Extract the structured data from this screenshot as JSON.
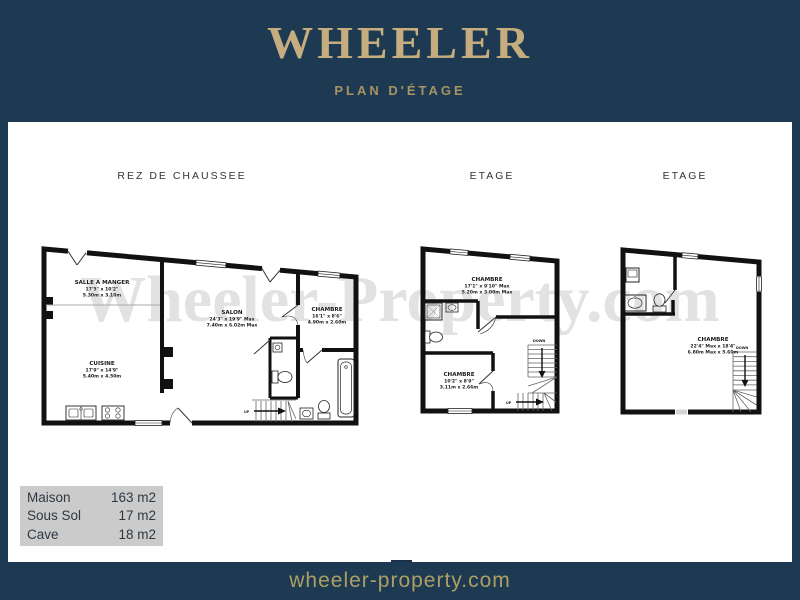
{
  "header": {
    "logo": "WHEELER",
    "subtitle": "PLAN D'ÉTAGE"
  },
  "watermark": "Wheeler-Property.com",
  "plans": [
    {
      "title": "REZ DE CHAUSSEE",
      "rooms": [
        {
          "name": "SALLE A MANGER",
          "imperial": "17'5\" x 10'2\"",
          "metric": "5.30m x 3.10m"
        },
        {
          "name": "SALON",
          "imperial": "24'3\" x 19'9\" Max",
          "metric": "7.40m x 6.02m Max"
        },
        {
          "name": "CHAMBRE",
          "imperial": "16'1\" x 8'6\"",
          "metric": "4.90m x 2.60m"
        },
        {
          "name": "CUISINE",
          "imperial": "17'9\" x 14'9\"",
          "metric": "5.40m x 4.50m"
        }
      ],
      "stairs": {
        "up": "UP"
      }
    },
    {
      "title": "ETAGE",
      "rooms": [
        {
          "name": "CHAMBRE",
          "imperial": "17'1\" x 9'10\" Max",
          "metric": "5.20m x 3.00m Max"
        },
        {
          "name": "CHAMBRE",
          "imperial": "10'2\" x 8'9\"",
          "metric": "3.11m x 2.66m"
        }
      ],
      "stairs": {
        "down": "DOWN",
        "up": "UP"
      }
    },
    {
      "title": "ETAGE",
      "rooms": [
        {
          "name": "CHAMBRE",
          "imperial": "22'4\" Max x 18'4\"",
          "metric": "6.80m Max x 5.60m"
        }
      ],
      "stairs": {
        "down": "DOWN"
      }
    }
  ],
  "summary": {
    "rows": [
      {
        "label": "Maison",
        "value": "163 m2"
      },
      {
        "label": "Sous Sol",
        "value": "17 m2"
      },
      {
        "label": "Cave",
        "value": "18 m2"
      }
    ]
  },
  "footer": {
    "website": "wheeler-property.com"
  },
  "colors": {
    "navy": "#1e3a52",
    "gold": "#c6ad7f",
    "gold_muted": "#a99263",
    "footer_text": "#ac9f66",
    "table_bg": "#cbcbcb",
    "wall": "#111111",
    "watermark": "#e2e2e2"
  }
}
